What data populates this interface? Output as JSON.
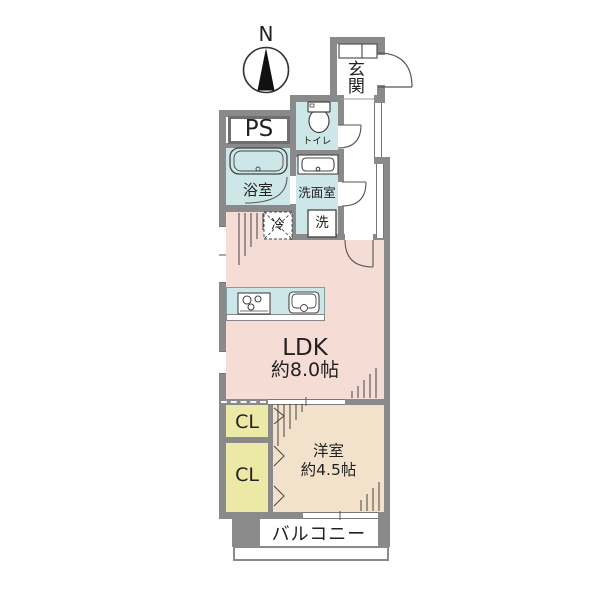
{
  "plan_title": "apartment-floor-plan",
  "compass": {
    "label": "N"
  },
  "rooms": {
    "genkan": {
      "label": "玄関"
    },
    "ps": {
      "label": "PS"
    },
    "toilet": {
      "label": "トイレ"
    },
    "bathroom": {
      "label": "浴室"
    },
    "washroom": {
      "label": "洗面室"
    },
    "laundry": {
      "label": "洗"
    },
    "refrigerator": {
      "label": "冷"
    },
    "ldk": {
      "label": "LDK",
      "size": "約8.0帖"
    },
    "closet1": {
      "label": "CL"
    },
    "closet2": {
      "label": "CL"
    },
    "western_room": {
      "label": "洋室",
      "size": "約4.5帖"
    },
    "balcony": {
      "label": "バルコニー"
    }
  },
  "colors": {
    "wall": "#8a8a8a",
    "line": "#4a4a4a",
    "wet_area_blue": "#cde7e8",
    "ldk_pink": "#f5dcd5",
    "western_beige": "#f2e2cb",
    "closet_yellow": "#ece8a6"
  }
}
